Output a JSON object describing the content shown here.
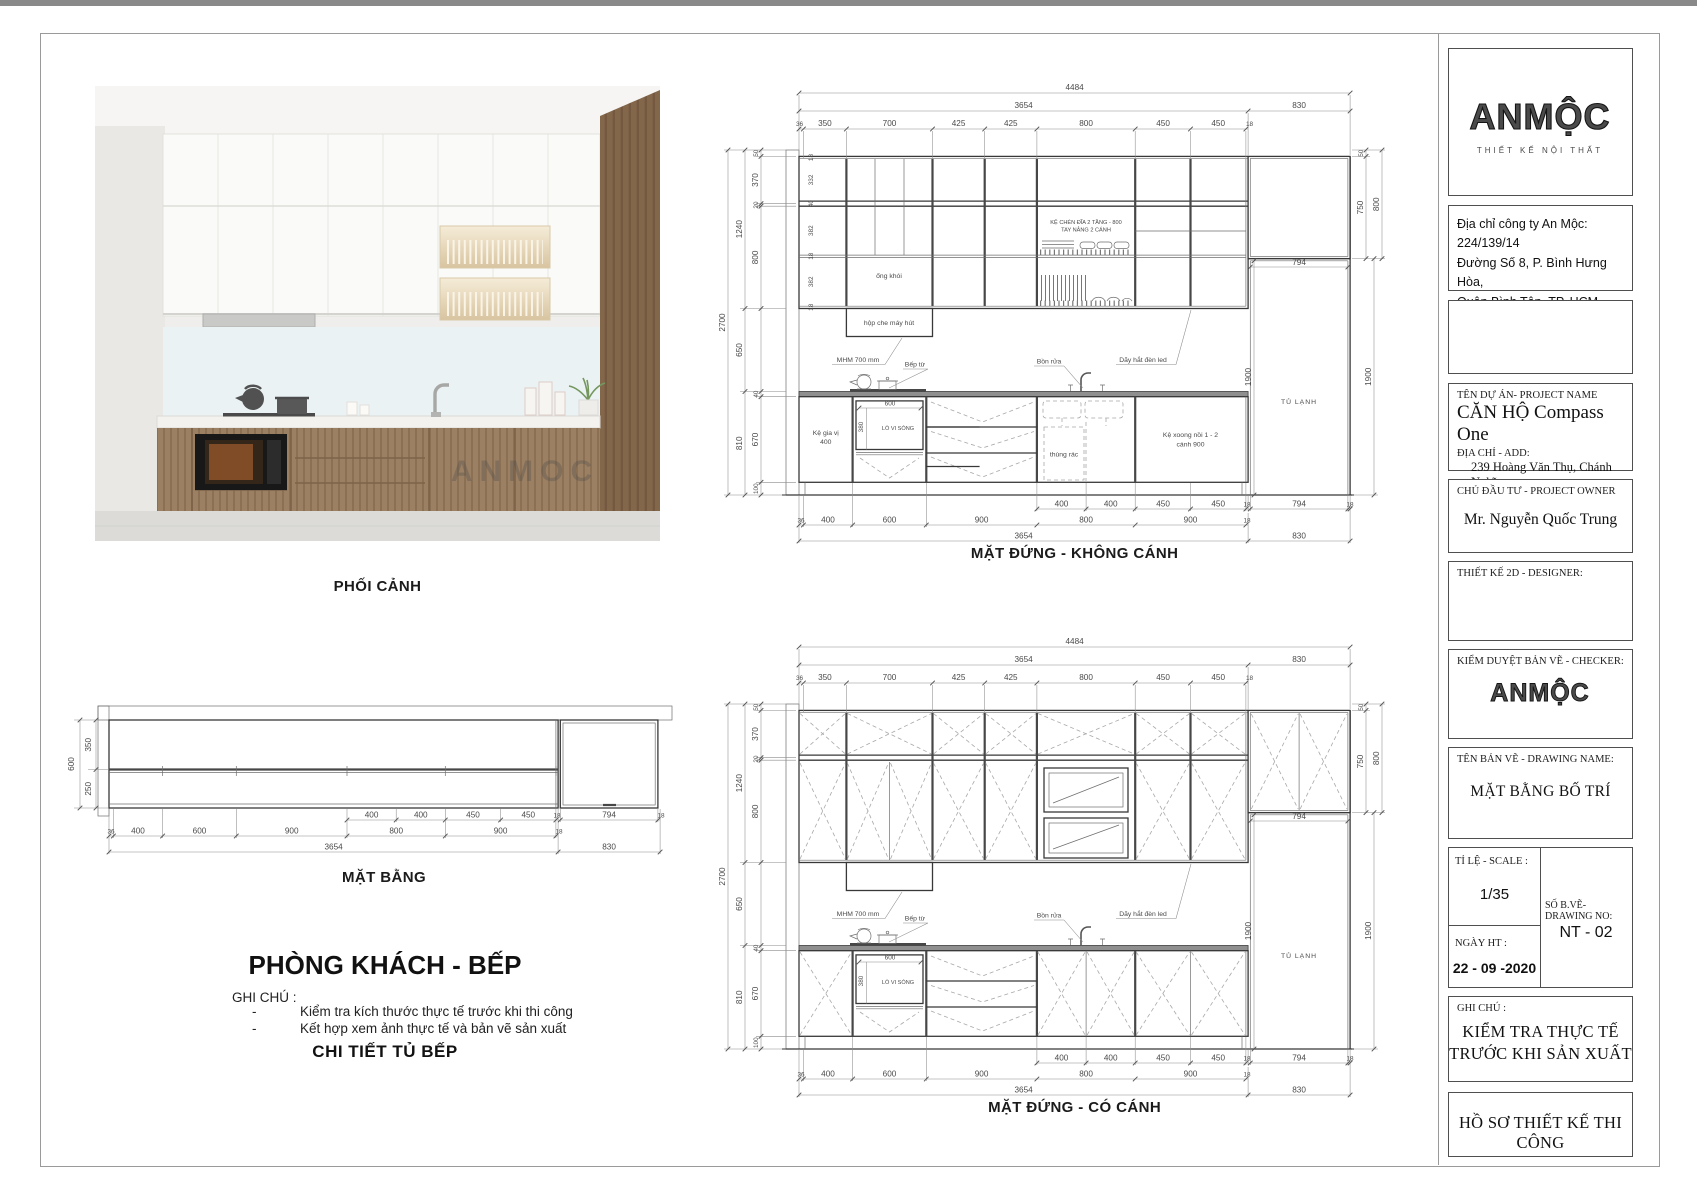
{
  "photo": {
    "caption": "PHỐI CẢNH",
    "watermark": "ANMOC"
  },
  "plan": {
    "title": "MẶT BẰNG",
    "left": {
      "depth_total": "600",
      "d1": "350",
      "d2": "250"
    },
    "b1": [
      "400",
      "400",
      "450",
      "450",
      "18",
      "794",
      "18"
    ],
    "b2": [
      "36",
      "400",
      "600",
      "900",
      "800",
      "900",
      "18"
    ],
    "b3": [
      "3654",
      "830"
    ]
  },
  "elevations": {
    "dims": {
      "top_total": "4484",
      "run": "3654",
      "tall": "830",
      "row": [
        "36",
        "350",
        "700",
        "425",
        "425",
        "800",
        "450",
        "450",
        "18"
      ],
      "left_total": "2700",
      "left_mid": [
        "1240",
        "650",
        "810"
      ],
      "left_inner": [
        "50",
        "370",
        "20",
        "800",
        "40",
        "670",
        "100"
      ],
      "left_small": [
        "18",
        "332",
        "40",
        "382",
        "18",
        "382",
        "18"
      ],
      "right": {
        "r50": "50",
        "r750": "750",
        "r800": "800",
        "r1900": "1900",
        "fridge_w": "794",
        "fridge_h": "1900"
      },
      "b1": [
        "400",
        "400",
        "450",
        "450",
        "18",
        "794",
        "18"
      ],
      "b2": [
        "36",
        "400",
        "600",
        "900",
        "800",
        "900",
        "18"
      ],
      "b3": [
        "3654",
        "830"
      ]
    },
    "no_doors": {
      "title": "MẶT ĐỨNG - KHÔNG CÁNH",
      "labels": {
        "rack1": "KỆ CHÉN ĐĨA 2 TẦNG - 800",
        "rack2": "TAY NÂNG 2 CÁNH",
        "flue": "ống khói",
        "hood": "hộp che máy hút",
        "mhm": "MHM 700 mm",
        "led": "Dãy hắt đèn led",
        "cooktop": "Bếp từ",
        "sink": "Bồn rửa",
        "spice1": "Kệ gia vị",
        "spice2": "400",
        "mw_w": "600",
        "mw_h": "380",
        "mw": "LÒ VI SÓNG",
        "trash": "thùng rác",
        "pots1": "Kệ xoong nồi 1 - 2",
        "pots2": "cánh 900",
        "fridge": "TỦ LẠNH"
      }
    },
    "with_doors": {
      "title": "MẶT ĐỨNG - CÓ CÁNH",
      "labels": {
        "mhm": "MHM 700 mm",
        "led": "Dãy hắt đèn led",
        "cooktop": "Bếp từ",
        "sink": "Bồn rửa",
        "mw_w": "600",
        "mw_h": "380",
        "mw": "LÒ VI SÓNG",
        "fridge": "TỦ LẠNH"
      }
    }
  },
  "notes": {
    "room": "PHÒNG KHÁCH - BẾP",
    "ghichu": "GHI CHÚ :",
    "bullet": "-",
    "items": [
      "Kiểm tra kích thước thực tế trước khi thi công",
      "Kết hợp xem ảnh thực tế và bản vẽ sản xuất"
    ],
    "detail": "CHI TIẾT TỦ BẾP"
  },
  "titleblock": {
    "logo": {
      "text": "ANMỘC",
      "subtitle": "THIẾT KẾ NỘI THẤT"
    },
    "address": {
      "l1": "Địa chỉ công ty An Mộc: 224/139/14",
      "l2": "Đường Số 8, P. Bình Hưng Hòa,",
      "l3": "Quận Bình Tân, TP. HCM"
    },
    "project": {
      "label": "TÊN DỰ ÁN- PROJECT NAME",
      "name": "CĂN HỘ Compass One",
      "addr_label": "ĐỊA CHỈ - ADD:",
      "addr1": "239 Hoàng Văn Thụ, Chánh Nghĩa,",
      "addr2": "Thủ Dầu Một, Bình Dương"
    },
    "owner": {
      "label": "CHỦ ĐẦU TƯ - PROJECT OWNER",
      "name": "Mr. Nguyễn Quốc Trung"
    },
    "designer": {
      "label": "THIẾT KẾ 2D - DESIGNER:"
    },
    "checker": {
      "label": "KIỂM DUYỆT BẢN VẼ - CHECKER:",
      "logo": "ANMỘC"
    },
    "drawing": {
      "label": "TÊN BẢN VẼ - DRAWING NAME:",
      "name": "MẶT BẰNG BỐ TRÍ"
    },
    "scale": {
      "label": "TỈ LỆ - SCALE :",
      "value": "1/35"
    },
    "number": {
      "label": "SỐ B.VẼ-DRAWING NO:",
      "value": "NT - 02"
    },
    "date": {
      "label": "NGÀY HT :",
      "value": "22 - 09 -2020"
    },
    "ghichu": {
      "label": "GHI CHÚ :",
      "l1": "KIỂM TRA THỰC TẾ",
      "l2": "TRƯỚC KHI SẢN XUẤT"
    },
    "footer": "HỒ SƠ THIẾT KẾ THI CÔNG"
  }
}
